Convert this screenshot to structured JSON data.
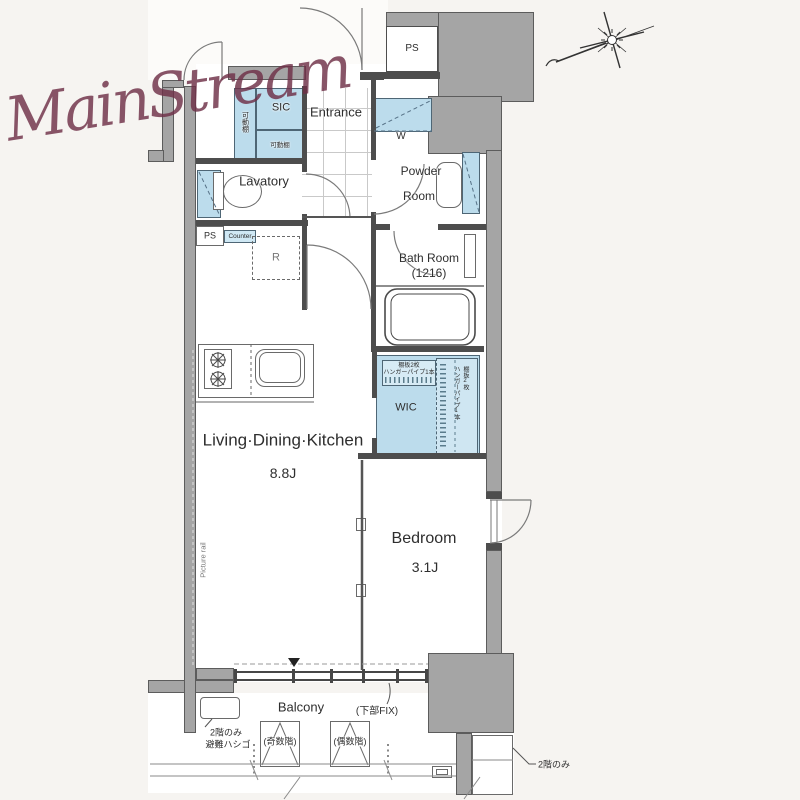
{
  "watermark": {
    "text": "MainStream"
  },
  "rooms": {
    "entrance": "Entrance",
    "sic": "SIC",
    "lavatory": "Lavatory",
    "powder1": "Powder",
    "powder2": "Room",
    "bath1": "Bath Room",
    "bath2": "(1216)",
    "wic": "WIC",
    "ldk1": "Living·Dining·Kitchen",
    "ldk2": "8.8J",
    "bedroom1": "Bedroom",
    "bedroom2": "3.1J",
    "balcony": "Balcony"
  },
  "labels": {
    "ps_top": "PS",
    "ps_left": "PS",
    "washer": "W",
    "fridge": "R",
    "counter": "Counter",
    "movable_shelf_v": "可動棚",
    "movable_shelf_h": "可動棚",
    "wic_note1": "棚板2枚",
    "wic_note2": "ハンガーパイプ1本",
    "wic_side1": "棚板2枚",
    "wic_side2": "ハンガーパイプ1本",
    "picture_rail": "Picture rail",
    "lower_fix": "(下部FIX)",
    "escape1": "2階のみ",
    "escape2": "避難ハシゴ",
    "odd_floors": "(奇数階)",
    "even_floors": "(偶数階)",
    "second_floor_only": "2階のみ"
  },
  "colors": {
    "wall": "#a5a5a5",
    "closet_blue": "#bcdcec",
    "watermark": "#6f3048",
    "interior": "#ffffff",
    "background": "#f6f4f1"
  }
}
